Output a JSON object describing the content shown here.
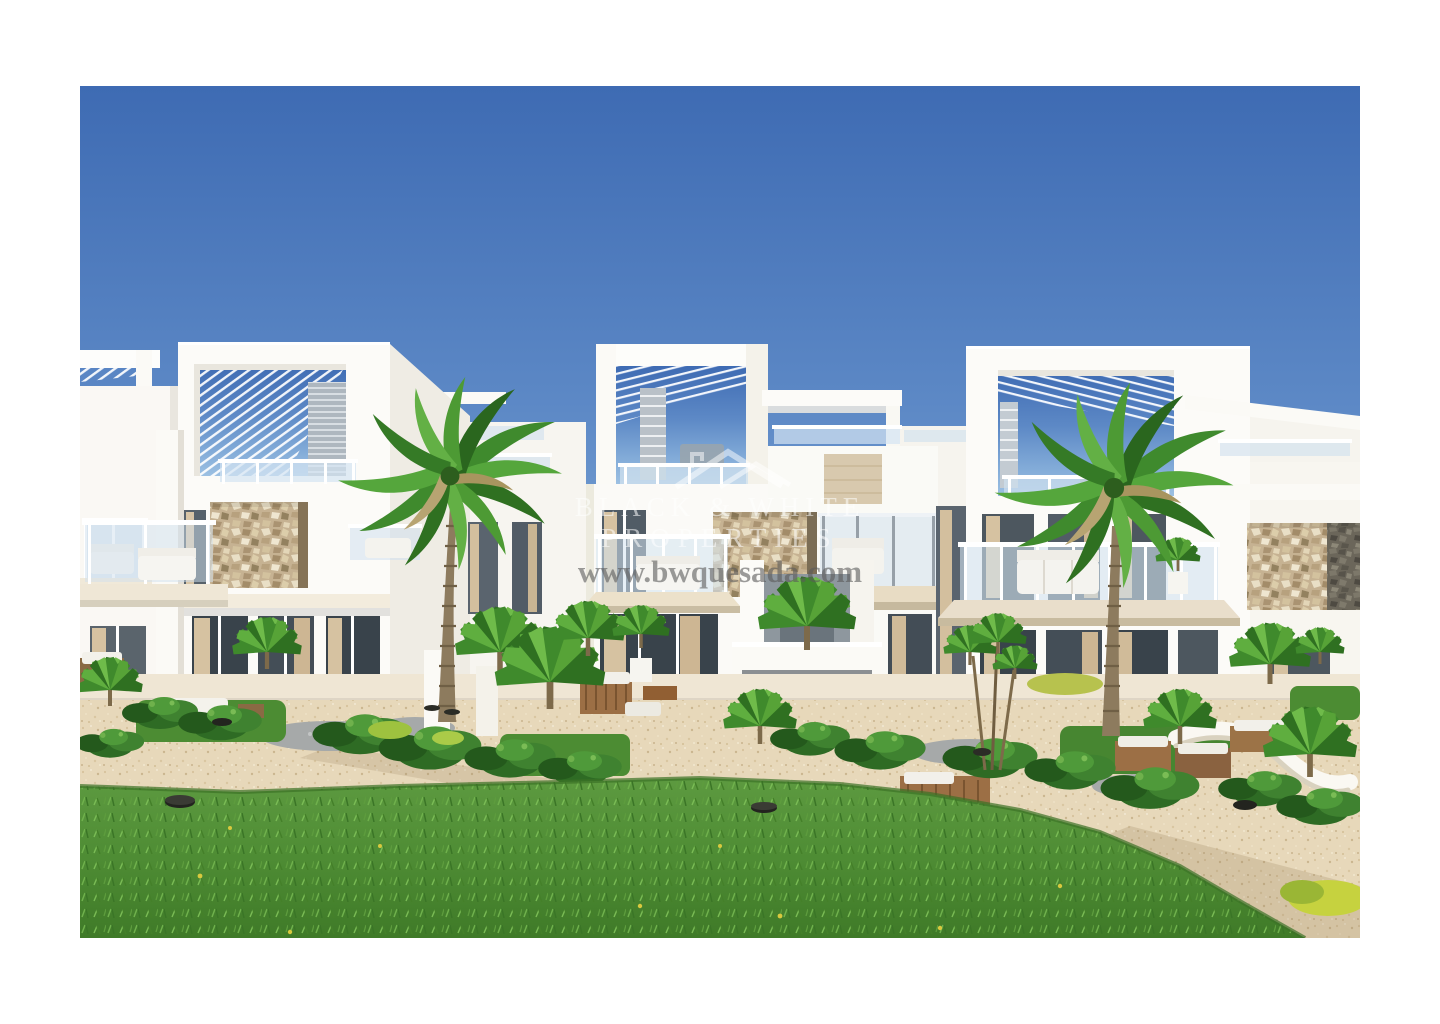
{
  "photo": {
    "kind": "architectural-render",
    "subject": "modern-white-apartment-complex-with-palm-trees-and-lawn",
    "watermark": {
      "logo": "double-roofline-icon",
      "brand_line1": "BLACK & WHITE",
      "brand_line2": "PROPERTIES",
      "website": "www.bwquesada.com"
    },
    "palette": {
      "sky_top": "#3e6bb3",
      "sky_horizon": "#9cc0e2",
      "building_white": "#fbfaf7",
      "building_shade": "#efece4",
      "stone_beige": "#c6b292",
      "gabion_gray": "#6b665a",
      "glass_blue": "#cfe0ee",
      "curtain_beige": "#d6c2a1",
      "terrace_tile": "#efe6d4",
      "gravel": "#e7d8ba",
      "lawn_green": "#4e8c34",
      "foliage_dark": "#2e6b24",
      "foliage_light": "#6fb14c",
      "trunk_brown": "#8d7b5e",
      "watermark_white": "rgba(255,255,255,0.55)",
      "watermark_gray": "#5a5a5a"
    }
  }
}
